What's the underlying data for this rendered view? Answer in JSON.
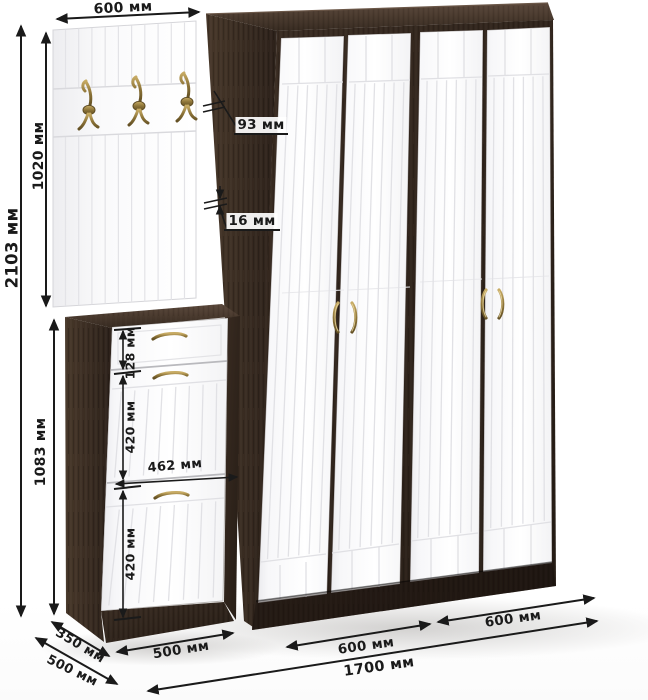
{
  "labels": {
    "dim_panel_width": "600 мм",
    "dim_total_height": "2103 мм",
    "dim_panel_height": "1020 мм",
    "dim_cabinet_height": "1083 мм",
    "dim_side_depth": "93 мм",
    "dim_panel_thickness": "16 мм",
    "dim_drawer_height": "128 мм",
    "dim_flap1_height": "420 мм",
    "dim_inner_width": "462 мм",
    "dim_flap2_height": "420 мм",
    "dim_cabinet_depth": "350 мм",
    "dim_cabinet_width": "500 мм",
    "dim_wardrobe_depth": "500 мм",
    "dim_section1_width": "600 мм",
    "dim_section2_width": "600 мм",
    "dim_total_width": "1700 мм"
  },
  "colors": {
    "wenge_dark": "#241b15",
    "wenge": "#362a21",
    "wenge_light": "#4a3a2e",
    "door_white": "#fafafb",
    "groove": "#e1e1e5",
    "brass": "#9c8143",
    "dimension": "#1a1a1a",
    "background": "#ffffff"
  }
}
